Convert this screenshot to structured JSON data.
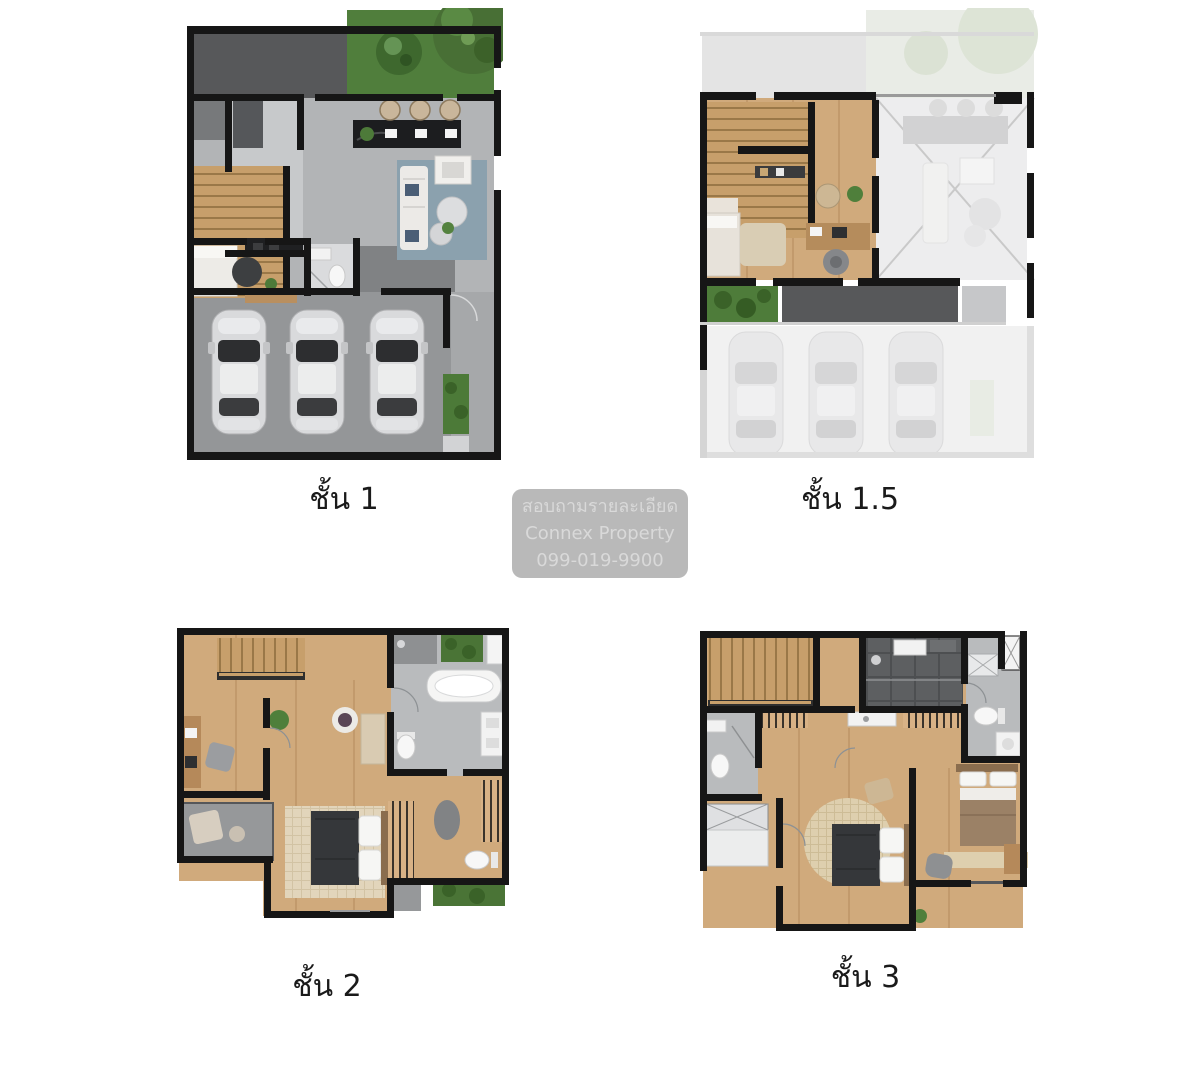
{
  "labels": {
    "floor1": "ชั้น 1",
    "floor1_5": "ชั้น 1.5",
    "floor2": "ชั้น 2",
    "floor3": "ชั้น 3"
  },
  "watermark": {
    "line1": "สอบถามรายละเอียด",
    "line2": "Connex Property",
    "line3": "099-019-9900"
  },
  "plans": [
    {
      "id": "floor-1",
      "label": "ชั้น 1",
      "features": [
        "terrace",
        "garden-trees",
        "kitchen-island",
        "bar-stools",
        "living-room-sofa",
        "rug",
        "staircase",
        "bedroom-bed",
        "bathroom",
        "garage-3-cars",
        "green-patch"
      ]
    },
    {
      "id": "floor-1-5",
      "label": "ชั้น 1.5",
      "features": [
        "staircase",
        "desk",
        "office-chair",
        "bed",
        "shelf",
        "void-over-living-room-ghosted",
        "balcony",
        "planter",
        "ghosted-garage-3-cars"
      ]
    },
    {
      "id": "floor-2",
      "label": "ชั้น 2",
      "features": [
        "staircase-railing",
        "bathroom-bathtub",
        "toilet",
        "vanity",
        "study-desk",
        "balcony-lounge",
        "master-bed",
        "wardrobe",
        "rug",
        "green-strip"
      ]
    },
    {
      "id": "floor-3",
      "label": "ชั้น 3",
      "features": [
        "staircase-railing",
        "shower-room-dark",
        "bathroom",
        "toilet",
        "vanity",
        "wardrobes",
        "closet",
        "bedroom-bed-round-rug",
        "bedroom-bed-2",
        "chair"
      ]
    }
  ],
  "colors": {
    "background": "#ffffff",
    "wall": "#161616",
    "wood_floor": "#d0aa7c",
    "stair_wood": "#c79f6b",
    "tile_gray": "#b4b6b8",
    "terrace_dark": "#57585a",
    "garage_gray": "#949698",
    "grass_green": "#4e7c3a",
    "rug_blue": "#8ba1ae",
    "rug_beige": "#e2d5bb",
    "ghost_gray": "#ededee",
    "bed_dark": "#35373a",
    "watermark_bg": "#b9b9b9",
    "watermark_text": "#d9d9d9",
    "label_text": "#1a1a1a"
  }
}
